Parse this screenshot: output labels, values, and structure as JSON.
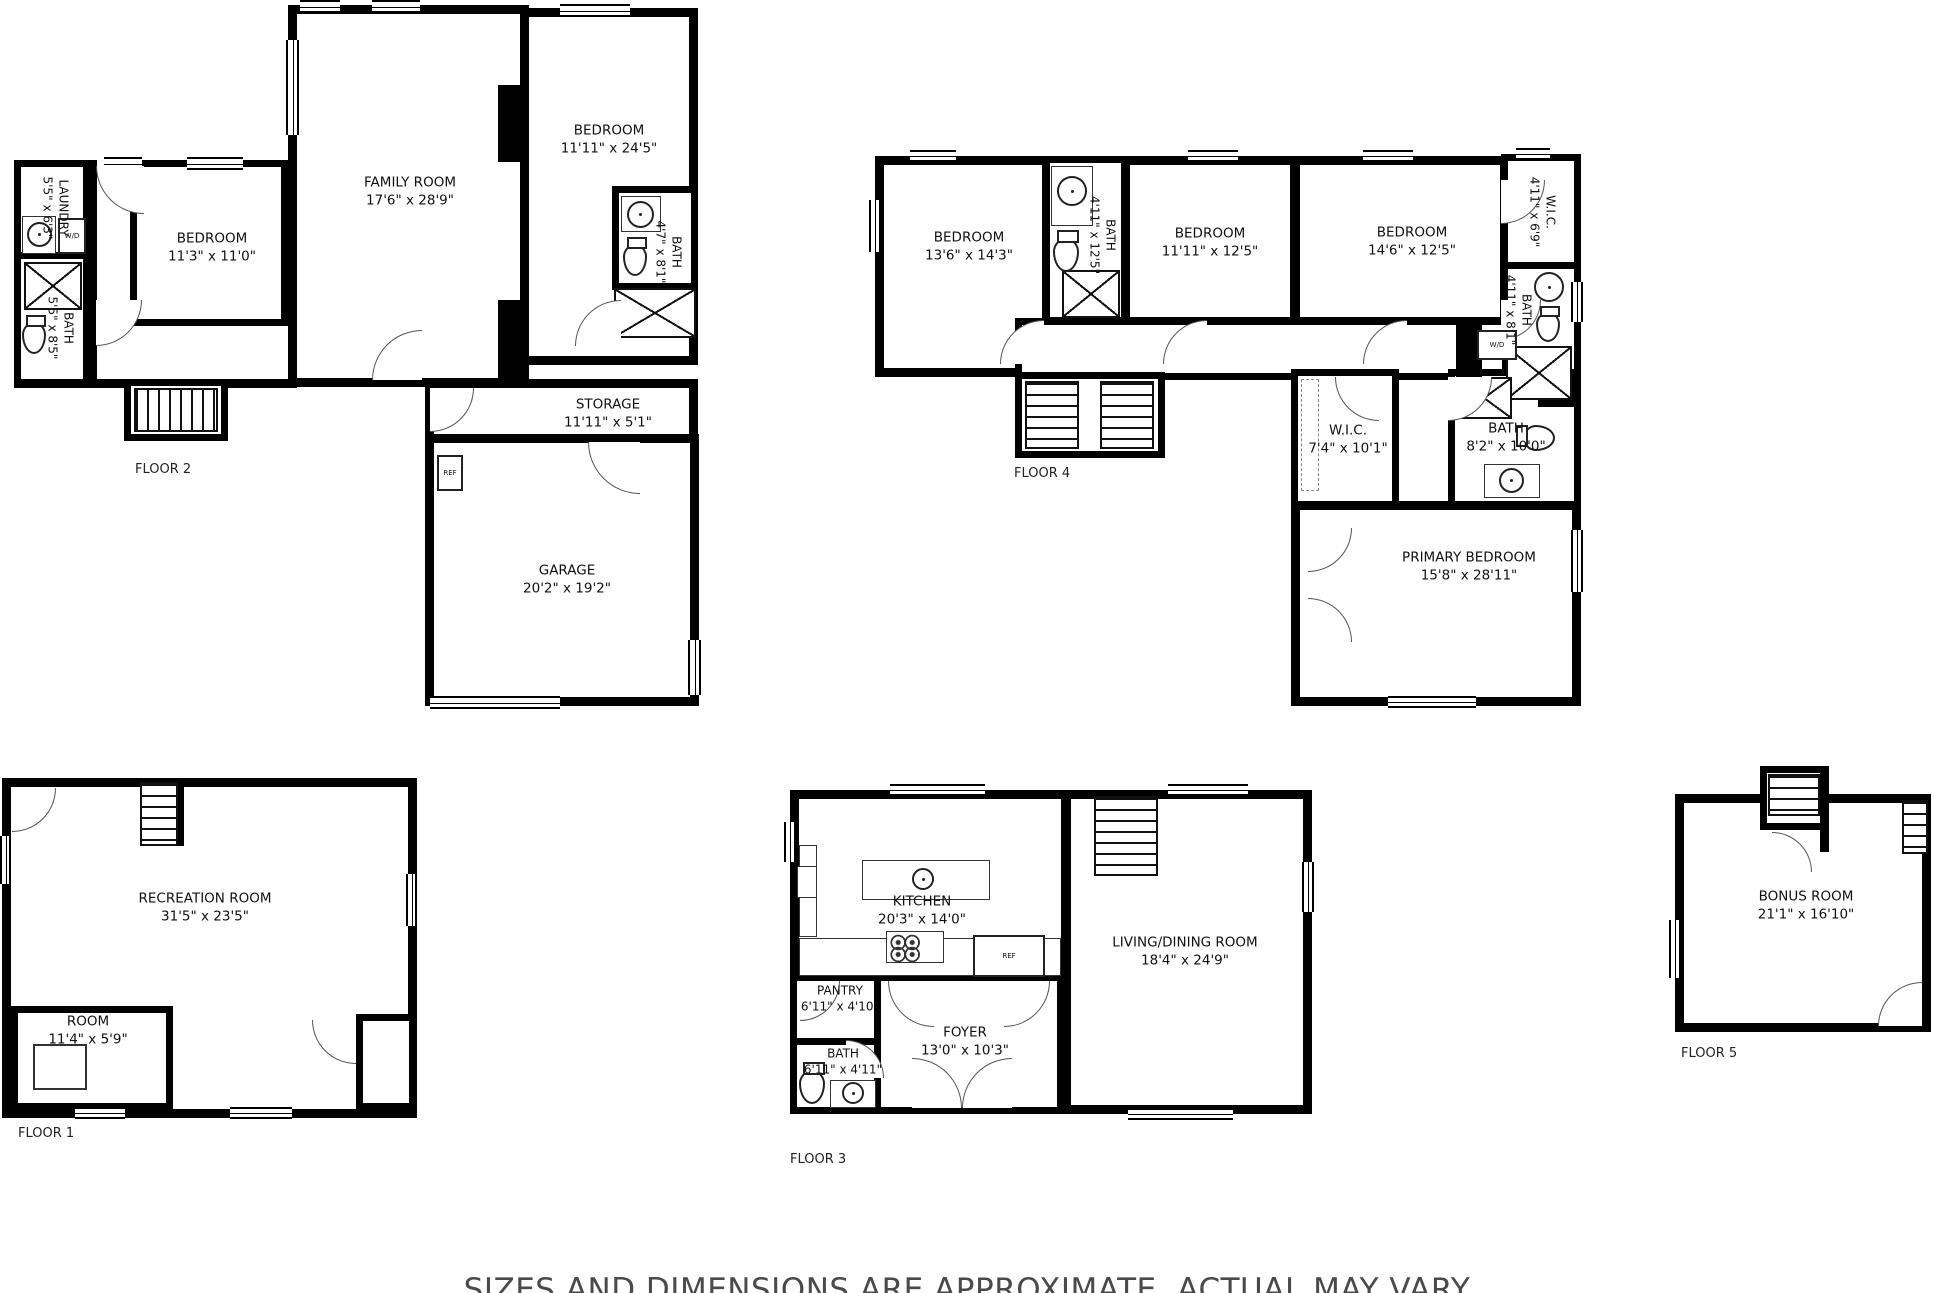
{
  "disclaimer": "SIZES AND DIMENSIONS ARE APPROXIMATE, ACTUAL MAY VARY",
  "appliances": {
    "ref": "REF",
    "wd": "W/D"
  },
  "floors": {
    "floor1": {
      "label": "FLOOR 1",
      "rooms": {
        "recreation": {
          "name": "RECREATION ROOM",
          "dims": "31'5\" x 23'5\""
        },
        "room": {
          "name": "ROOM",
          "dims": "11'4\" x 5'9\""
        }
      }
    },
    "floor2": {
      "label": "FLOOR 2",
      "rooms": {
        "family": {
          "name": "FAMILY ROOM",
          "dims": "17'6\" x 28'9\""
        },
        "bedroom_a": {
          "name": "BEDROOM",
          "dims": "11'11\" x 24'5\""
        },
        "bedroom_b": {
          "name": "BEDROOM",
          "dims": "11'3\" x 11'0\""
        },
        "laundry": {
          "name": "LAUNDRY",
          "dims": "5'5\" x 6'3\""
        },
        "bath_a": {
          "name": "BATH",
          "dims": "5'5\" x 8'5\""
        },
        "bath_b": {
          "name": "BATH",
          "dims": "4'7\" x 8'1\""
        },
        "storage": {
          "name": "STORAGE",
          "dims": "11'11\" x 5'1\""
        },
        "garage": {
          "name": "GARAGE",
          "dims": "20'2\" x 19'2\""
        }
      }
    },
    "floor3": {
      "label": "FLOOR 3",
      "rooms": {
        "kitchen": {
          "name": "KITCHEN",
          "dims": "20'3\" x 14'0\""
        },
        "living": {
          "name": "LIVING/DINING ROOM",
          "dims": "18'4\" x 24'9\""
        },
        "pantry": {
          "name": "PANTRY",
          "dims": "6'11\" x 4'10\""
        },
        "foyer": {
          "name": "FOYER",
          "dims": "13'0\" x 10'3\""
        },
        "bath": {
          "name": "BATH",
          "dims": "6'11\" x 4'11\""
        }
      }
    },
    "floor4": {
      "label": "FLOOR 4",
      "rooms": {
        "bedroom_a": {
          "name": "BEDROOM",
          "dims": "13'6\" x 14'3\""
        },
        "bath_a": {
          "name": "BATH",
          "dims": "4'11\" x 12'5\""
        },
        "bedroom_b": {
          "name": "BEDROOM",
          "dims": "11'11\" x 12'5\""
        },
        "bedroom_c": {
          "name": "BEDROOM",
          "dims": "14'6\" x 12'5\""
        },
        "wic_a": {
          "name": "W.I.C.",
          "dims": "4'11\" x 6'9\""
        },
        "bath_b": {
          "name": "BATH",
          "dims": "4'11\" x 8'1\""
        },
        "wic_b": {
          "name": "W.I.C.",
          "dims": "7'4\" x 10'1\""
        },
        "bath_c": {
          "name": "BATH",
          "dims": "8'2\" x 10'0\""
        },
        "primary": {
          "name": "PRIMARY BEDROOM",
          "dims": "15'8\" x 28'11\""
        }
      }
    },
    "floor5": {
      "label": "FLOOR 5",
      "rooms": {
        "bonus": {
          "name": "BONUS ROOM",
          "dims": "21'1\" x 16'10\""
        }
      }
    }
  }
}
